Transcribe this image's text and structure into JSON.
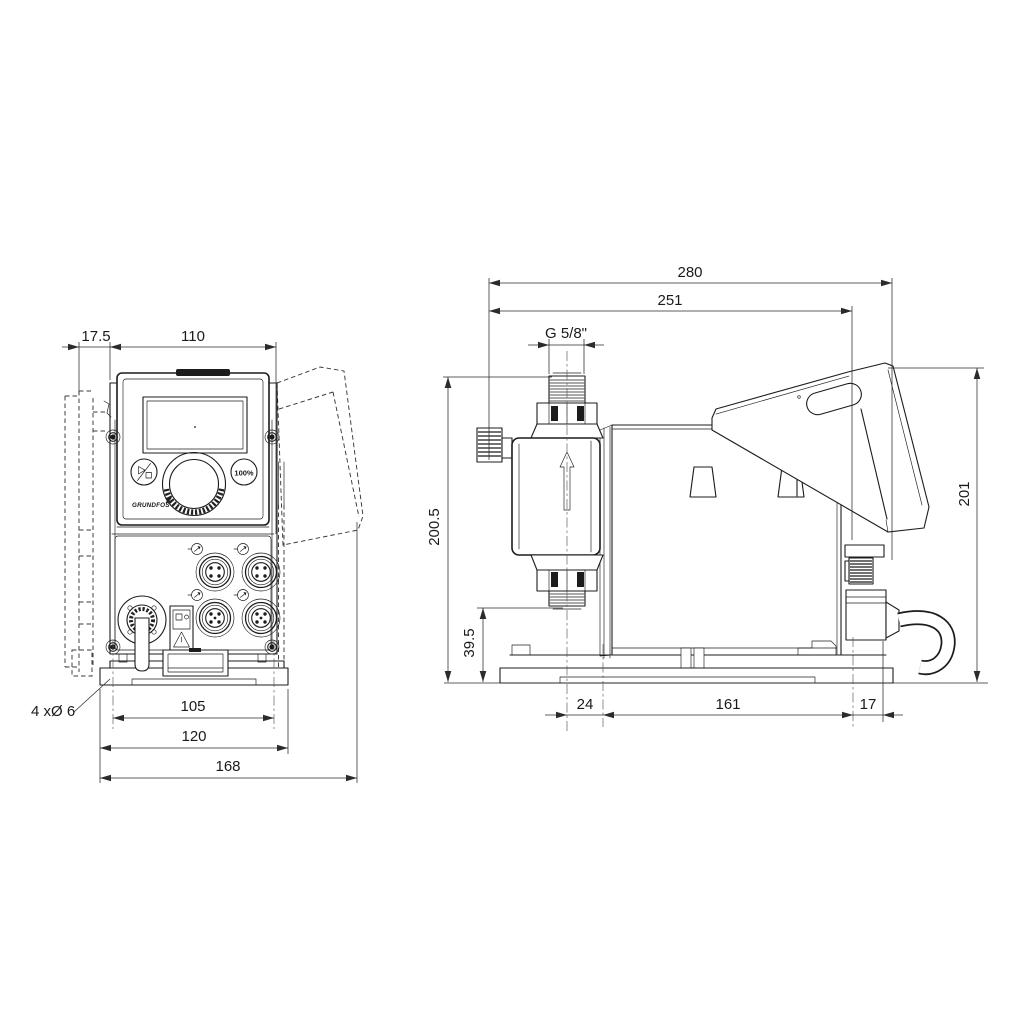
{
  "page": {
    "background": "#ffffff",
    "line_color": "#1c1c1c"
  },
  "front_view": {
    "dim_bracket_depth": "17.5",
    "dim_housing_width": "110",
    "note_mounting_holes": "4 xØ 6",
    "dim_hole_spacing": "105",
    "dim_plate_width": "120",
    "dim_overall_depth": "168",
    "panel": {
      "logo": "GRUNDFOS",
      "capacity_button": "100%"
    }
  },
  "side_view": {
    "dim_overall_length": "280",
    "dim_length_to_rear_holes": "251",
    "dim_connection_thread": "G 5/8\"",
    "dim_overall_height": "200.5",
    "dim_valve_outlet_height": "39.5",
    "dim_rear_height": "201",
    "dim_valve_to_front_hole": "24",
    "dim_foot_hole_spacing": "161",
    "dim_hole_to_rear_edge": "17"
  }
}
